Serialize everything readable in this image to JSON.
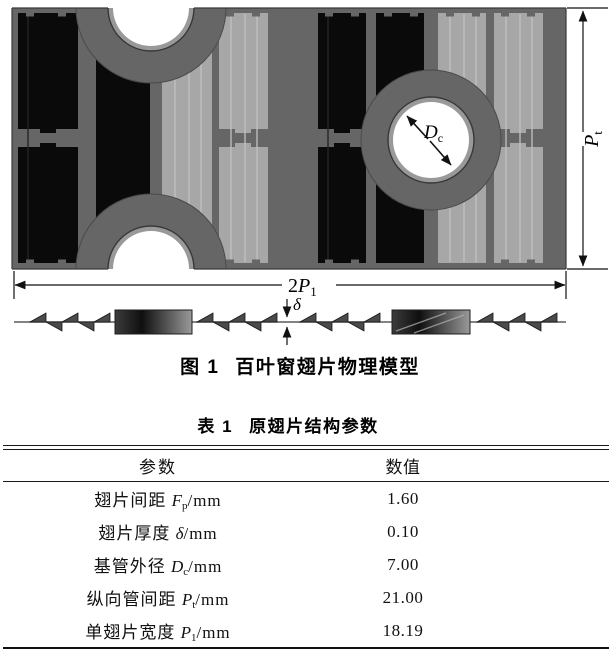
{
  "figure": {
    "caption_label": "图 1",
    "caption_text": "百叶窗翅片物理模型",
    "dims": {
      "tube_outer_diameter": {
        "main": "D",
        "sub": "c"
      },
      "transverse_tube_pitch": {
        "main": "P",
        "sub": "t"
      },
      "fin_total_width": {
        "prefix": "2",
        "main": "P",
        "sub": "1"
      },
      "fin_thickness": {
        "main": "δ"
      }
    },
    "colors": {
      "plate": "#666666",
      "louver_dark": "#0a0a0a",
      "louver_light": "#a7a7a7",
      "tube_hole": "#ffffff",
      "collar_ring": "#999999"
    }
  },
  "table": {
    "title_label": "表 1",
    "title_text": "原翅片结构参数",
    "columns": [
      "参数",
      "数值"
    ],
    "rows": [
      {
        "param_parts": [
          {
            "t": "翅片间距 "
          },
          {
            "t": "F",
            "style": "var"
          },
          {
            "t": "p",
            "style": "sub"
          },
          {
            "t": "/mm"
          }
        ],
        "value": "1.60"
      },
      {
        "param_parts": [
          {
            "t": "翅片厚度 "
          },
          {
            "t": "δ",
            "style": "var"
          },
          {
            "t": "/mm"
          }
        ],
        "value": "0.10"
      },
      {
        "param_parts": [
          {
            "t": "基管外径 "
          },
          {
            "t": "D",
            "style": "var"
          },
          {
            "t": "c",
            "style": "sub"
          },
          {
            "t": "/mm"
          }
        ],
        "value": "7.00"
      },
      {
        "param_parts": [
          {
            "t": "纵向管间距 "
          },
          {
            "t": "P",
            "style": "var"
          },
          {
            "t": "t",
            "style": "sub"
          },
          {
            "t": "/mm"
          }
        ],
        "value": "21.00"
      },
      {
        "param_parts": [
          {
            "t": "单翅片宽度 "
          },
          {
            "t": "P",
            "style": "var"
          },
          {
            "t": "1",
            "style": "sub"
          },
          {
            "t": "/mm"
          }
        ],
        "value": "18.19"
      }
    ]
  }
}
